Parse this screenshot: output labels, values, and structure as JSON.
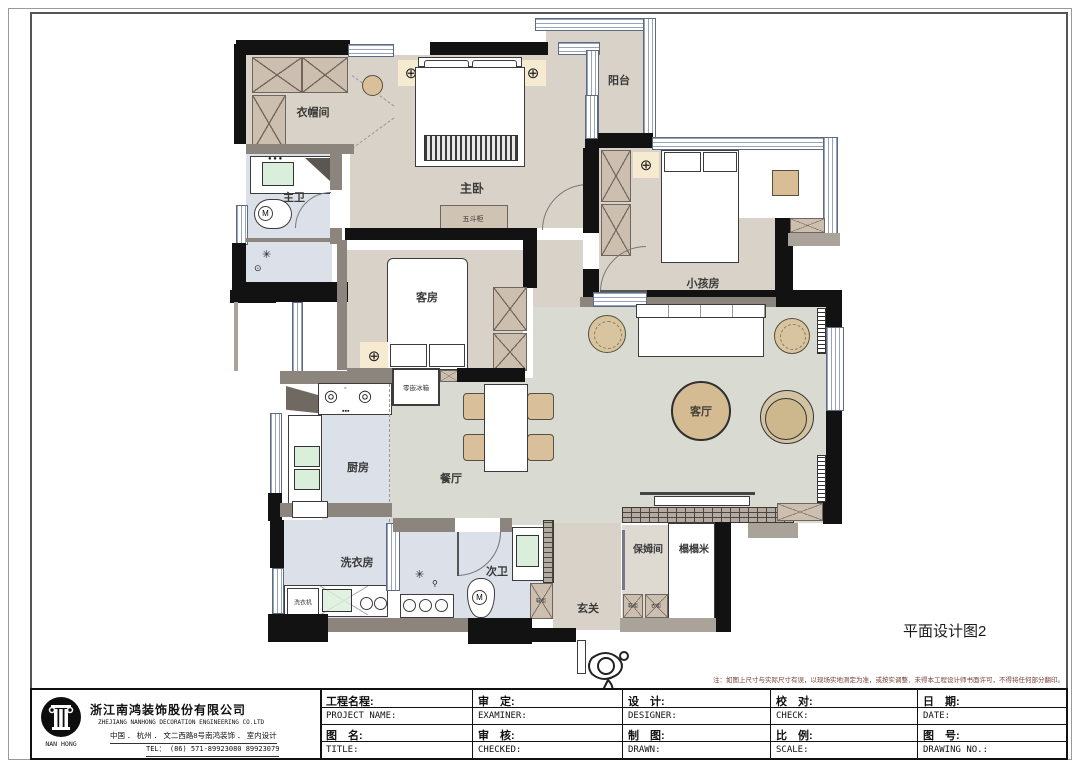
{
  "drawing_label": "平面设计图2",
  "note": "注：如图上尺寸与实际尺寸有误，以现场实地测定为准，或按实调整．未得本工程设计师书面许可，不得将任何部分翻印。",
  "company": {
    "logo_text": "NAN HONG",
    "name_cn": "浙江南鸿装饰股份有限公司",
    "name_en": "ZHEJIANG NANHONG DECORATION ENGINEERING CO.LTD",
    "address": "中国 ． 杭州 ． 文二西路8号南鸿装饰 ． 室内设计",
    "tel": "TEL：  (86) 571-89923080   89923079"
  },
  "titleblock": {
    "project_cn": "工程名程:",
    "project_en": "PROJECT NAME:",
    "examiner_cn": "审　定:",
    "examiner_en": "EXAMINER:",
    "designer_cn": "设　计:",
    "designer_en": "DESIGNER:",
    "check_cn": "校　对:",
    "check_en": "CHECK:",
    "date_cn": "日　期:",
    "date_en": "DATE:",
    "title_cn": "图　名:",
    "title_en": "TITLE:",
    "checked_cn": "审　核:",
    "checked_en": "CHECKED:",
    "drawn_cn": "制　图:",
    "drawn_en": "DRAWN:",
    "scale_cn": "比　例:",
    "scale_en": "SCALE:",
    "drawing_no_cn": "图　号:",
    "drawing_no_en": "DRAWING NO.:"
  },
  "rooms": {
    "cloakroom": "衣帽间",
    "master_bath": "主卫",
    "master_bedroom": "主卧",
    "balcony": "阳台",
    "kids_room": "小孩房",
    "guest_room": "客房",
    "living_room": "客厅",
    "kitchen": "厨房",
    "dining_room": "餐厅",
    "laundry": "洗衣房",
    "second_bath": "次卫",
    "foyer": "玄关",
    "nanny_room": "保姆间",
    "tatami": "榻榻米"
  },
  "furniture": {
    "dresser": "五斗柜",
    "fridge": "零嵌冰箱",
    "washer": "洗衣机",
    "shoe_cabinet_foyer": "鞋柜",
    "shoe_cabinet_nanny": "鞋柜",
    "wardrobe_nanny": "衣柜"
  },
  "colors": {
    "wall": "#121212",
    "partition": "#8b857d",
    "floor_warm": "#d8d2c8",
    "floor_cool": "#d9dad2",
    "floor_wet": "#dce0e9",
    "furniture_tan": "#d5bb92",
    "note_red": "#7a4036"
  }
}
